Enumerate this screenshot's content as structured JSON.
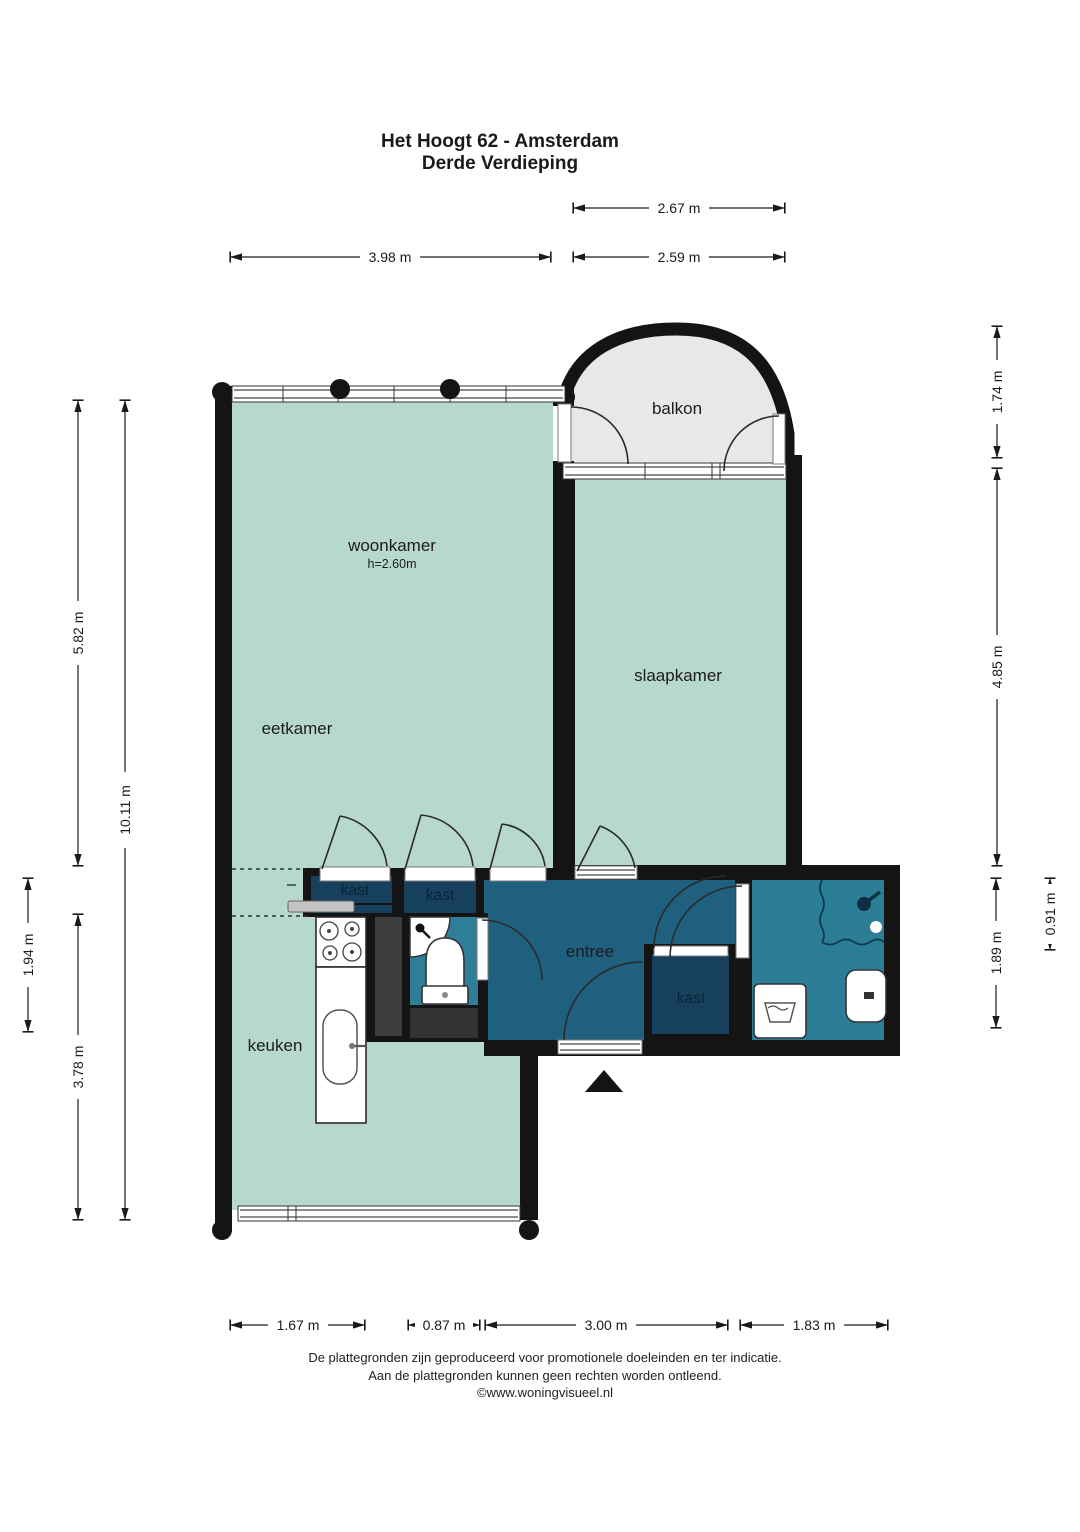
{
  "title": {
    "line1": "Het Hoogt 62 - Amsterdam",
    "line2": "Derde Verdieping"
  },
  "rooms": {
    "balkon": {
      "label": "balkon"
    },
    "woonkamer": {
      "label": "woonkamer",
      "ceiling_height": "h=2.60m"
    },
    "slaapkamer": {
      "label": "slaapkamer"
    },
    "eetkamer": {
      "label": "eetkamer"
    },
    "keuken": {
      "label": "keuken"
    },
    "entree": {
      "label": "entree"
    },
    "kast1": {
      "label": "kast"
    },
    "kast2": {
      "label": "kast"
    },
    "kast3": {
      "label": "kast"
    }
  },
  "dimensions": {
    "top_balkon": "2.67 m",
    "top_woonkamer": "3.98 m",
    "top_slaapkamer": "2.59 m",
    "left_woonkamer": "5.82 m",
    "left_totaal": "10.11 m",
    "left_midden": "1.94 m",
    "left_keuken": "3.78 m",
    "right_balkon": "1.74 m",
    "right_slaapkamer": "4.85 m",
    "right_badkamer": "1.89 m",
    "right_douche": "0.91 m",
    "bottom_keuken": "1.67 m",
    "bottom_midden": "0.87 m",
    "bottom_entree": "3.00 m",
    "bottom_badkamer": "1.83 m"
  },
  "footer": {
    "line1": "De plattegronden zijn geproduceerd voor promotionele doeleinden en ter indicatie.",
    "line2": "Aan de plattegronden kunnen geen rechten worden ontleend.",
    "line3": "©www.woningvisueel.nl"
  },
  "colors": {
    "room_light": "#b7d8cc",
    "balkon": "#e8e8e8",
    "entree": "#20607f",
    "kast": "#16405e",
    "toilet": "#2e7d99",
    "badkamer": "#2c7e97",
    "shaft": "#3c3c3c",
    "shaft_dark": "#333333",
    "wall": "#141414",
    "counter_gray": "#c4c4c4"
  }
}
